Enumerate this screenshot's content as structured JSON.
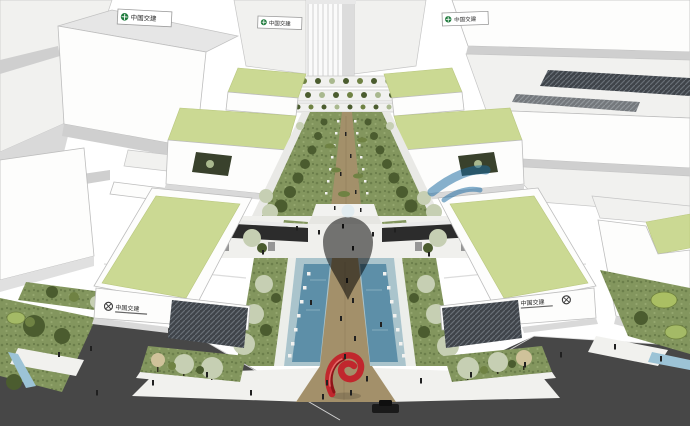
{
  "scene": {
    "description": "Aerial 3D architectural rendering of a business park: white buildings with lime-green roofs flanking a central landscaped pedestrian axis with rows of trees, a blue water channel, a red ribbon sculpture at the street entrance, dark asphalt roads, and a translucent blue logo watermark over the center.",
    "signs": {
      "top_left": "中国交建",
      "top_center": "中国交建",
      "top_right": "中国交建",
      "front_left": "中国交建",
      "front_right": "中国交建"
    },
    "watermark": {
      "color": "#2D8FC2",
      "opacity": 0.52
    },
    "palette": {
      "building_white": "#FFFFFF",
      "roof_green": "#CBD993",
      "lawn_green": "#83965E",
      "tree_dark": "#4B5C2F",
      "tree_light": "#C6CFB3",
      "water_blue": "#5D8FA8",
      "pool_deck_blue": "#AAC4CC",
      "path_tan": "#A3906A",
      "road_gray": "#474747",
      "sculpture_red": "#C1272D",
      "sign_green": "#1E7A3C",
      "car_black": "#1A1A1A"
    }
  }
}
